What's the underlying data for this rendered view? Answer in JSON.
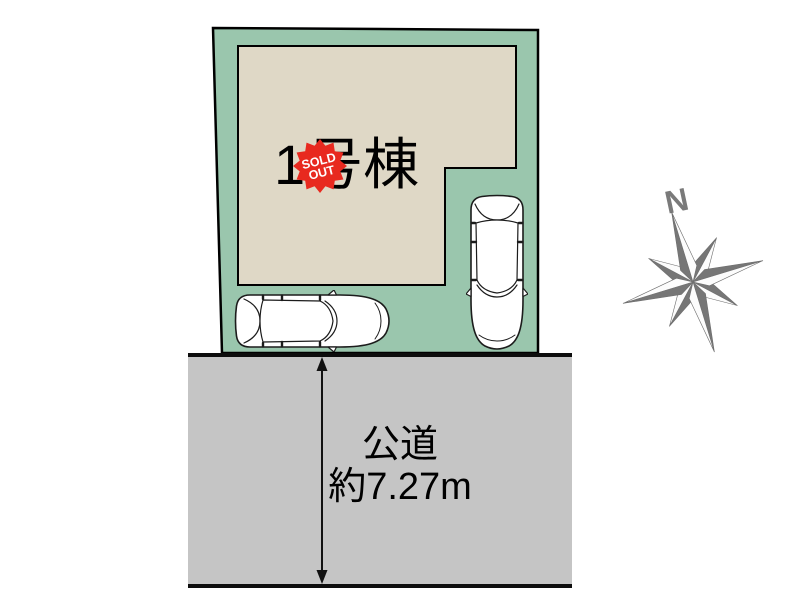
{
  "site_plan": {
    "building": {
      "label": "1号棟"
    },
    "sold_out_badge": {
      "line1": "SOLD",
      "line2": "OUT"
    },
    "colors": {
      "plot_green": "#9ac6ad",
      "building_beige": "#dfd8c6",
      "road_gray": "#c5c5c5",
      "badge_red": "#e8291f",
      "compass_gray": "#7a7a7a",
      "outline_black": "#000000"
    },
    "icons": {
      "car_horizontal": "car-top-view-icon",
      "car_vertical": "car-top-view-icon",
      "compass": "compass-rose-icon",
      "road_arrow": "double-arrow-icon",
      "badge": "starburst-seal-icon"
    }
  },
  "road": {
    "name": "公道",
    "width_label": "約7.27m"
  },
  "compass": {
    "north_label": "N"
  }
}
